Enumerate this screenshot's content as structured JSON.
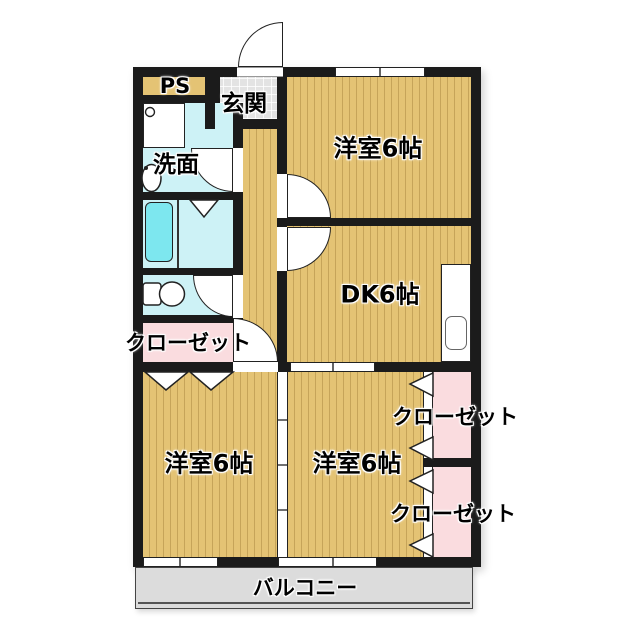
{
  "palette": {
    "wall": "#1b1b1b",
    "wood_floor": "#e4c374",
    "water_rooms": "#cdf2f6",
    "bathtub": "#7de7ef",
    "closet_pink": "#fadcdf",
    "entrance_gray": "#e3e3e3",
    "balcony_gray": "#dcdcdc"
  },
  "labels": {
    "ps": "PS",
    "entrance": "玄関",
    "washroom": "洗面",
    "room_top_right": "洋室6帖",
    "dining_kitchen": "DK6帖",
    "closet_left": "クローゼット",
    "room_bottom_left": "洋室6帖",
    "room_bottom_right": "洋室6帖",
    "closet_right_upper": "クローゼット",
    "closet_right_lower": "クローゼット",
    "balcony": "バルコニー"
  }
}
